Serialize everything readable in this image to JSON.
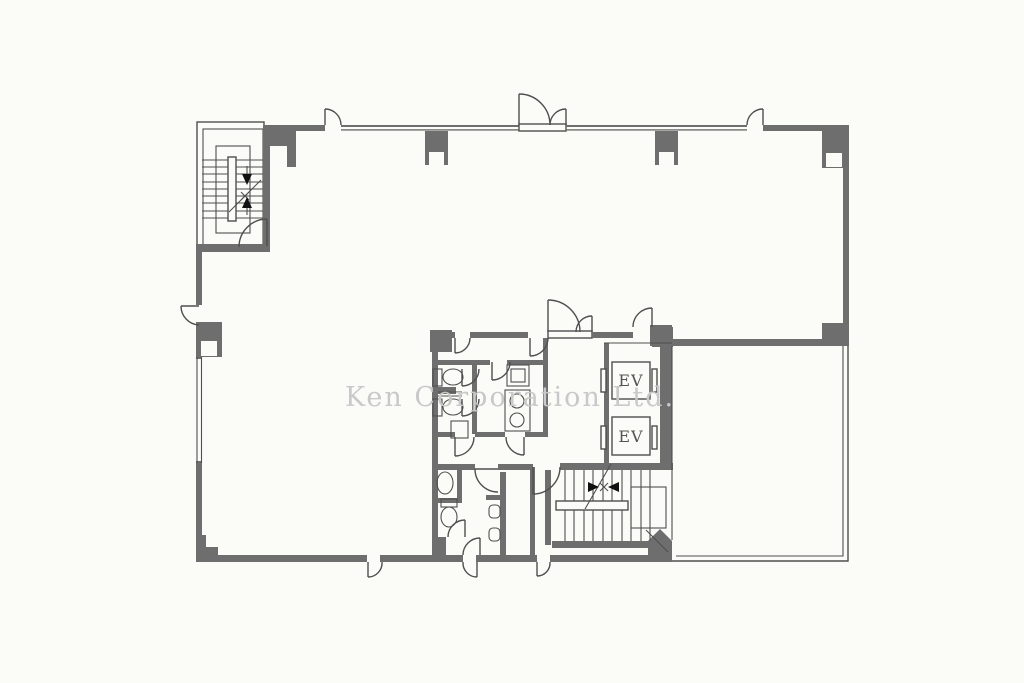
{
  "watermark": {
    "text": "Ken Corporation Ltd."
  },
  "elevators": {
    "ev1": "EV",
    "ev2": "EV"
  },
  "colors": {
    "wall": "#6e6e6e",
    "line": "#4f4f4f",
    "watermark": "#c9c9c9",
    "background": "#fbfbf7"
  }
}
